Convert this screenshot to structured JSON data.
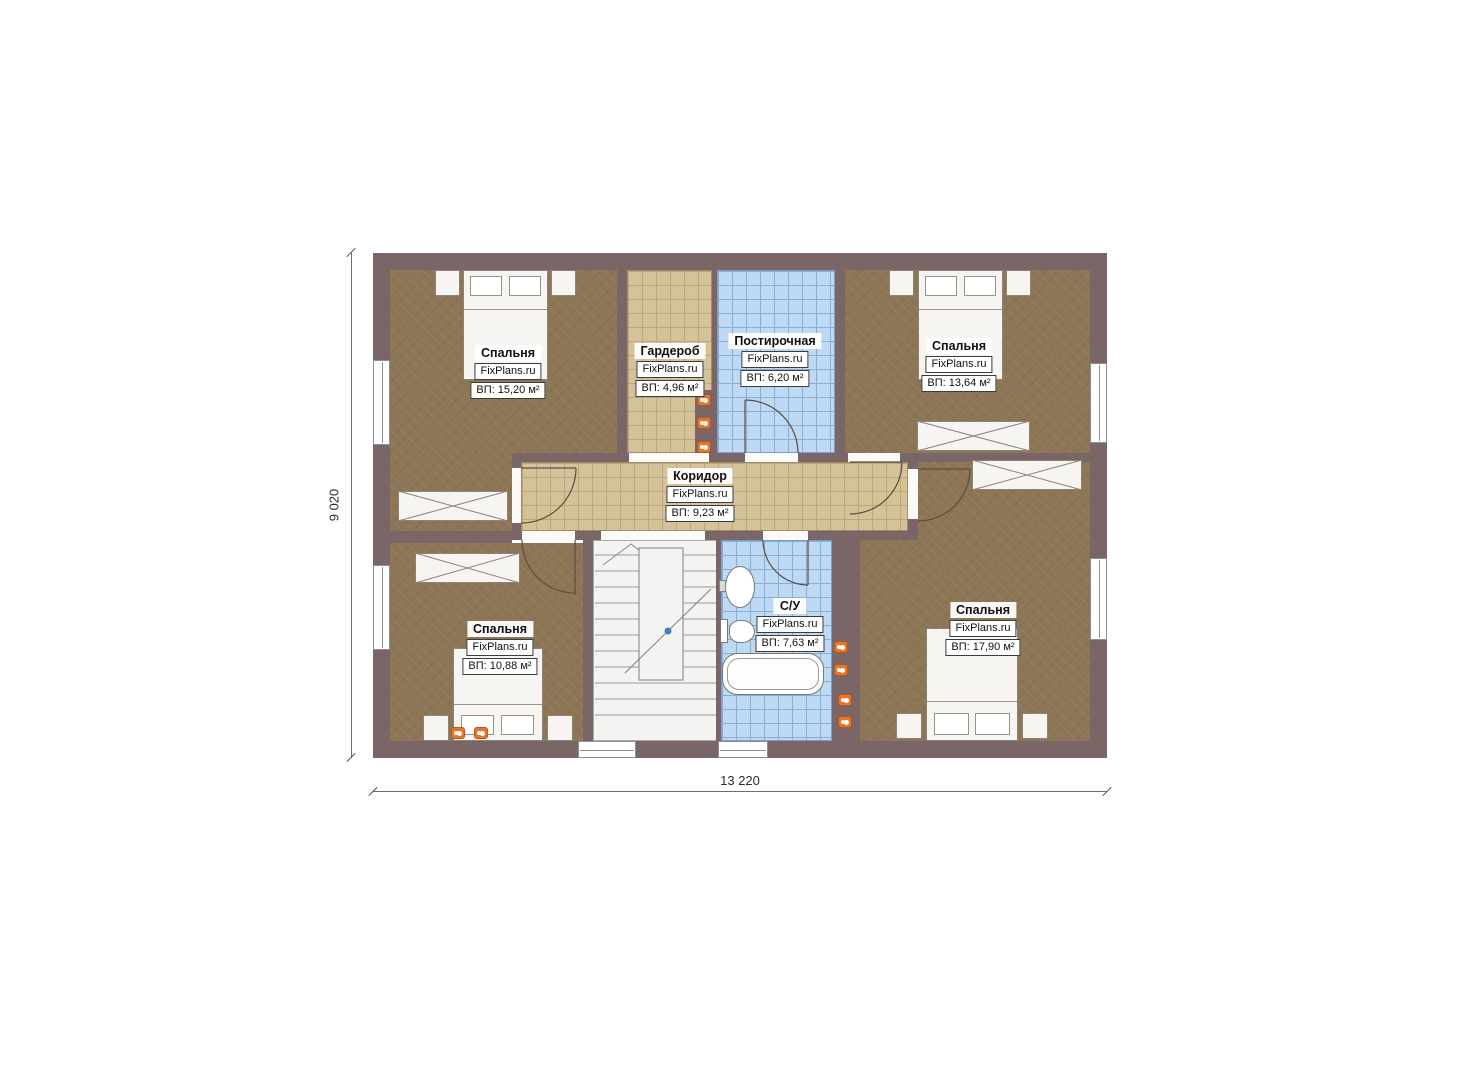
{
  "plan": {
    "brand": "FixPlans.ru",
    "rooms": [
      {
        "name": "Спальня",
        "brand": "FixPlans.ru",
        "area": "ВП: 15,20 м²"
      },
      {
        "name": "Гардероб",
        "brand": "FixPlans.ru",
        "area": "ВП: 4,96 м²"
      },
      {
        "name": "Постирочная",
        "brand": "FixPlans.ru",
        "area": "ВП: 6,20 м²"
      },
      {
        "name": "Спальня",
        "brand": "FixPlans.ru",
        "area": "ВП: 13,64 м²"
      },
      {
        "name": "Коридор",
        "brand": "FixPlans.ru",
        "area": "ВП: 9,23 м²"
      },
      {
        "name": "Спальня",
        "brand": "FixPlans.ru",
        "area": "ВП: 10,88 м²"
      },
      {
        "name": "С/У",
        "brand": "FixPlans.ru",
        "area": "ВП: 7,63 м²"
      },
      {
        "name": "Спальня",
        "brand": "FixPlans.ru",
        "area": "ВП: 17,90 м²"
      }
    ],
    "dimensions": {
      "overall_width": "13 220",
      "overall_height": "9 020"
    },
    "colors": {
      "wall": "#7b6667",
      "bedroom_floor": "#8d7656",
      "tile_floor": "#d5c298",
      "wet_floor": "#bdd9f3",
      "socket": "#e8762a"
    }
  }
}
